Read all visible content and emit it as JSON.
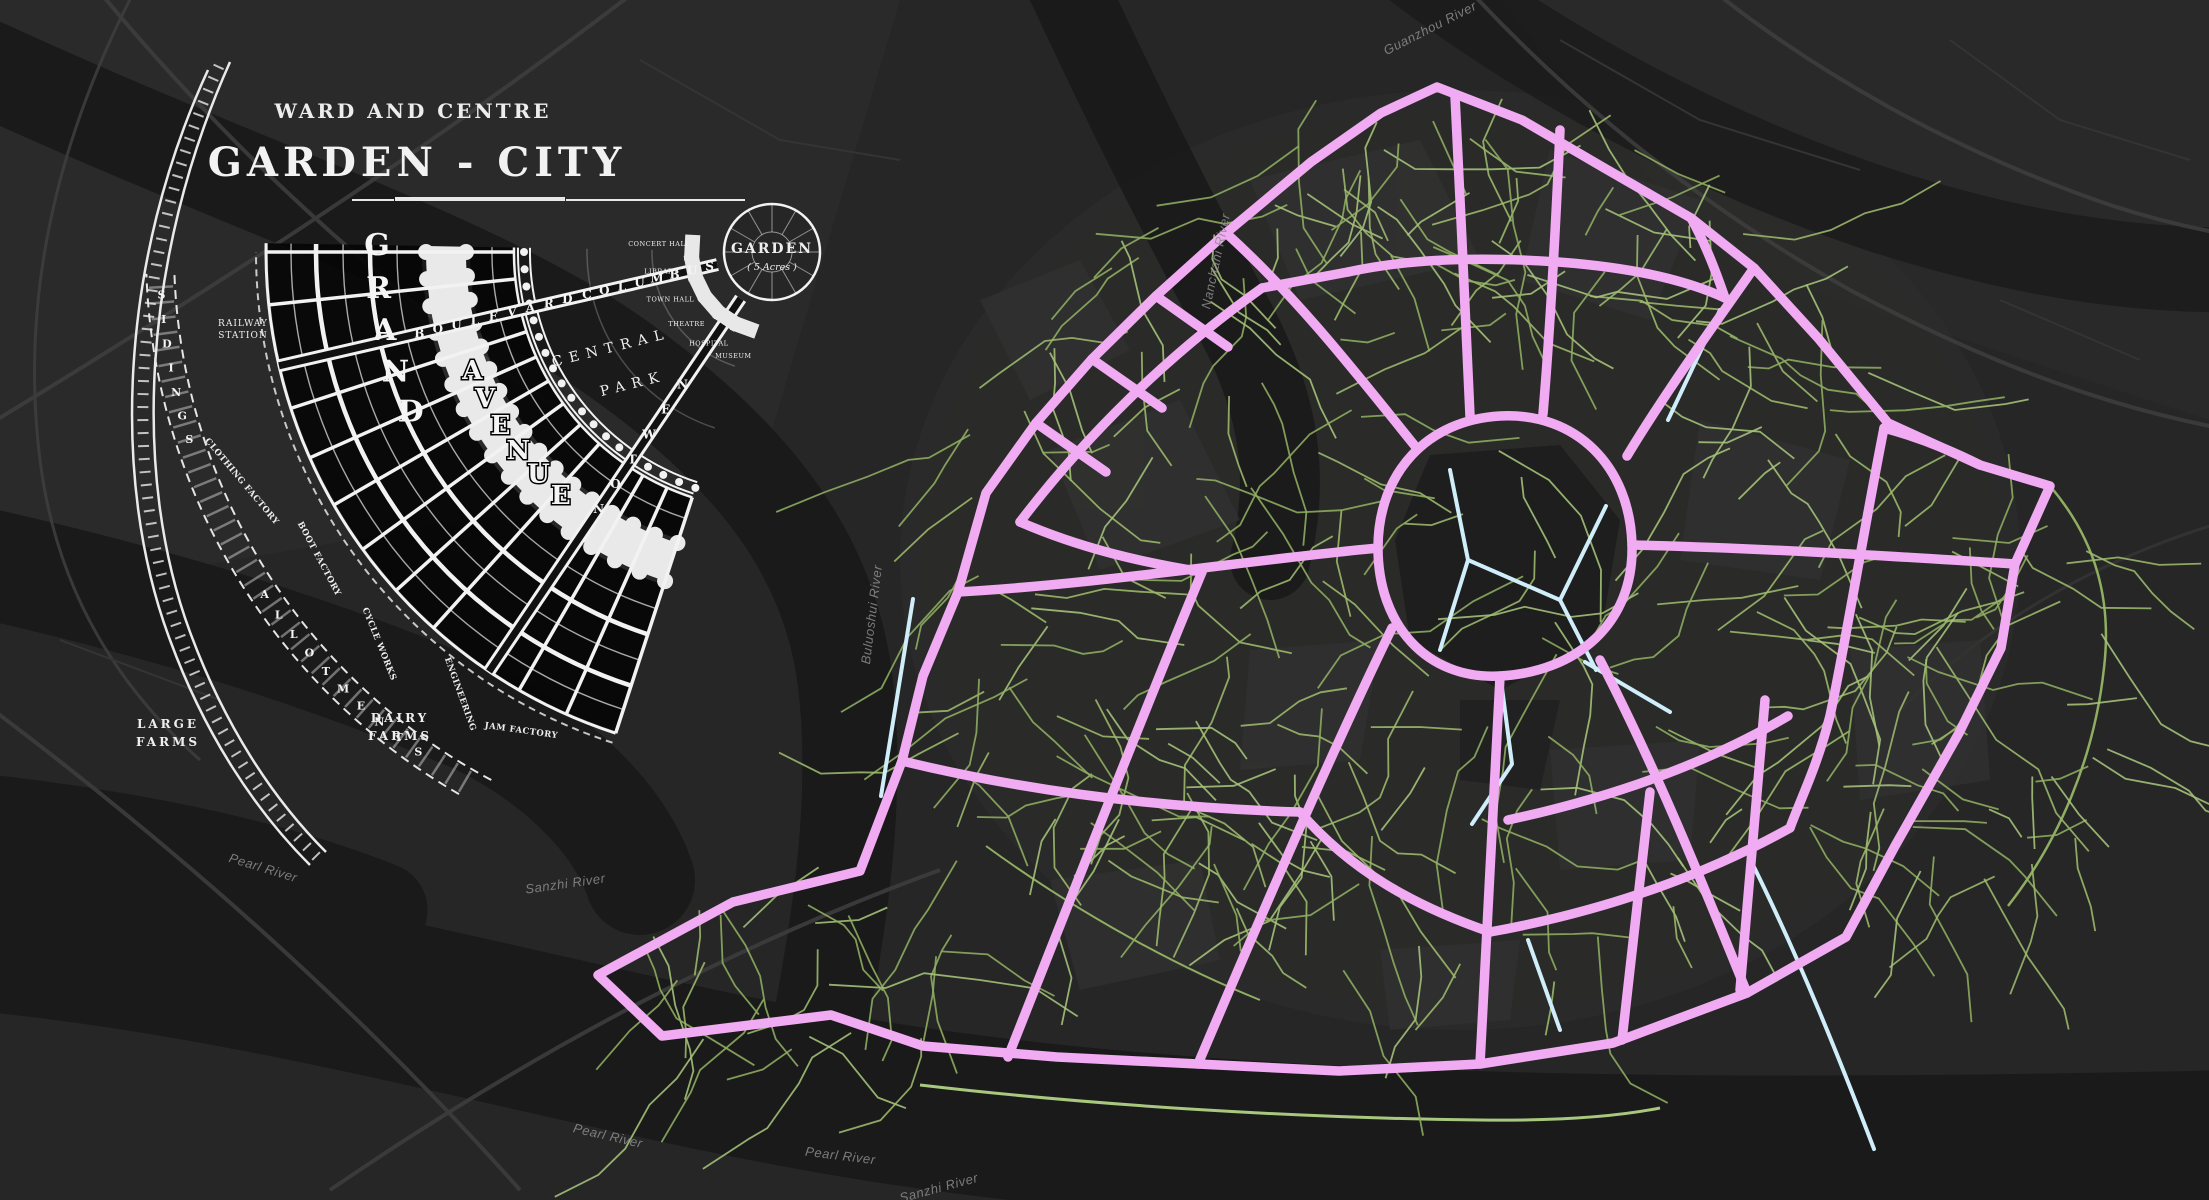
{
  "view": {
    "description": "Dark basemap with historical Garden City ward diagram inset and a planned-city road network overlay",
    "colors": {
      "background": "#262626",
      "planned_primary_roads": "#f0abf2",
      "secondary_roads": "#cfeefa",
      "minor_roads": "#9dbb6d",
      "water": "#1a1a1a",
      "diagram_ink": "#f5f5f5",
      "basemap_roads": "#3d3d3d"
    }
  },
  "inset_diagram": {
    "title_line1": "WARD AND CENTRE",
    "title_line2": "GARDEN - CITY",
    "streets": {
      "boulevard": "BOULEVARD",
      "columbus": "COLUMBUS",
      "newton": "NEWTON",
      "grand": "GRAND",
      "avenue": "AVENUE"
    },
    "areas": {
      "central_park_line1": "CENTRAL",
      "central_park_line2": "PARK",
      "garden": "GARDEN",
      "garden_size": "( 5 Acres )",
      "sidings": "SIDINGS",
      "allotments": "ALLOTMENTS",
      "large_farms_line1": "LARGE",
      "large_farms_line2": "FARMS",
      "dairy_farms_line1": "DAIRY",
      "dairy_farms_line2": "FARMS"
    },
    "station_line1": "RAILWAY",
    "station_line2": "STATION",
    "factories": [
      "CLOTHING FACTORY",
      "BOOT FACTORY",
      "CYCLE WORKS",
      "ENGINEERING",
      "JAM FACTORY"
    ],
    "civic_buildings": [
      "MUSEUM",
      "HOSPITAL",
      "THEATRE",
      "TOWN HALL",
      "LIBRARY",
      "CONCERT HALL"
    ]
  },
  "water_labels": [
    {
      "text": "Pearl River",
      "x": 262,
      "y": 872,
      "rotate": 17
    },
    {
      "text": "Sanzhi River",
      "x": 566,
      "y": 888,
      "rotate": -8
    },
    {
      "text": "Pearl River",
      "x": 607,
      "y": 1140,
      "rotate": 13
    },
    {
      "text": "Pearl River",
      "x": 840,
      "y": 1160,
      "rotate": 7
    },
    {
      "text": "Sanzhi River",
      "x": 940,
      "y": 1192,
      "rotate": -15
    },
    {
      "text": "Buluoshui River",
      "x": 876,
      "y": 615,
      "rotate": -83
    },
    {
      "text": "Nanchahi River",
      "x": 1220,
      "y": 262,
      "rotate": -78
    },
    {
      "text": "Guanzhou River",
      "x": 1432,
      "y": 32,
      "rotate": -27
    }
  ]
}
